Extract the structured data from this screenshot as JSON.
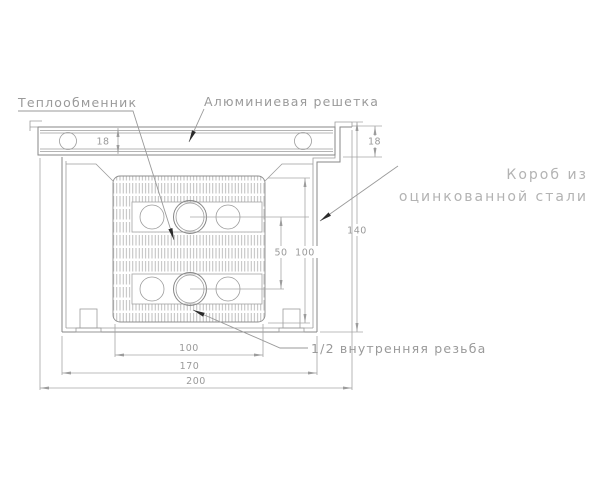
{
  "drawing": {
    "labels": {
      "heat_exchanger": "Теплообменник",
      "aluminum_grille": "Алюминиевая решетка",
      "galvanized_box_line1": "Короб из",
      "galvanized_box_line2": "оцинкованной стали",
      "internal_thread": "1/2 внутренняя резьба"
    },
    "dimensions": {
      "grille_height": "18",
      "box_upstand_height": "18",
      "overall_height": "140",
      "core_height": "100",
      "pipe_spacing": "50",
      "core_width": "100",
      "box_width": "170",
      "overall_width": "200"
    },
    "colors": {
      "geometry_line": "#878787",
      "dimension_line": "#a6a6a6",
      "label_text": "#9a9a9a",
      "light_label_text": "#b3b3b3",
      "leader_arrow": "#2b2b2b",
      "background": "#ffffff"
    }
  }
}
